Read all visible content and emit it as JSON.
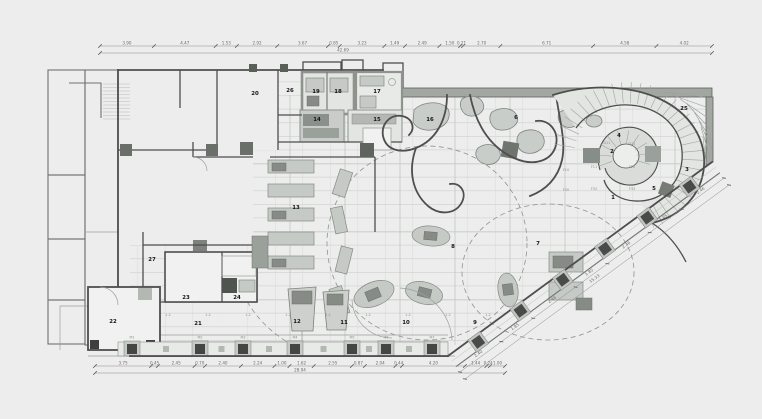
{
  "drawing": {
    "background": "#ecedec",
    "line_dark": "#4e4e4e",
    "line_mid": "#8a8f8a",
    "line_light": "#cdd0cd",
    "furniture_fill": "#c6cac6",
    "poche_fill": "#a2a7a2",
    "room_label_color": "#151515",
    "dim_color": "#6d6d6d"
  },
  "rooms": [
    {
      "n": "1",
      "x": 613,
      "y": 199
    },
    {
      "n": "2",
      "x": 612,
      "y": 153
    },
    {
      "n": "3",
      "x": 687,
      "y": 171
    },
    {
      "n": "4",
      "x": 619,
      "y": 137
    },
    {
      "n": "5",
      "x": 654,
      "y": 190
    },
    {
      "n": "6",
      "x": 516,
      "y": 119
    },
    {
      "n": "7",
      "x": 538,
      "y": 245
    },
    {
      "n": "8",
      "x": 453,
      "y": 248
    },
    {
      "n": "9",
      "x": 475,
      "y": 324
    },
    {
      "n": "10",
      "x": 406,
      "y": 324
    },
    {
      "n": "11",
      "x": 344,
      "y": 324
    },
    {
      "n": "12",
      "x": 297,
      "y": 323
    },
    {
      "n": "13",
      "x": 296,
      "y": 209
    },
    {
      "n": "14",
      "x": 317,
      "y": 121
    },
    {
      "n": "15",
      "x": 377,
      "y": 121
    },
    {
      "n": "16",
      "x": 430,
      "y": 121
    },
    {
      "n": "17",
      "x": 377,
      "y": 93
    },
    {
      "n": "18",
      "x": 338,
      "y": 93
    },
    {
      "n": "19",
      "x": 316,
      "y": 93
    },
    {
      "n": "20",
      "x": 255,
      "y": 95
    },
    {
      "n": "21",
      "x": 198,
      "y": 325
    },
    {
      "n": "22",
      "x": 113,
      "y": 323
    },
    {
      "n": "23",
      "x": 186,
      "y": 299
    },
    {
      "n": "24",
      "x": 237,
      "y": 299
    },
    {
      "n": "25",
      "x": 684,
      "y": 110
    },
    {
      "n": "26",
      "x": 290,
      "y": 92
    },
    {
      "n": "27",
      "x": 152,
      "y": 261
    }
  ],
  "codes": [
    {
      "t": "D11",
      "x": 607,
      "y": 144
    },
    {
      "t": "D12",
      "x": 632,
      "y": 145
    },
    {
      "t": "F11",
      "x": 594,
      "y": 168
    },
    {
      "t": "F12",
      "x": 632,
      "y": 168
    },
    {
      "t": "F32",
      "x": 594,
      "y": 190
    },
    {
      "t": "F33",
      "x": 632,
      "y": 190
    },
    {
      "t": "F10",
      "x": 566,
      "y": 171
    },
    {
      "t": "F30",
      "x": 566,
      "y": 191
    },
    {
      "t": "1.2",
      "x": 168,
      "y": 316
    },
    {
      "t": "1.2",
      "x": 208,
      "y": 316
    },
    {
      "t": "1.2",
      "x": 248,
      "y": 316
    },
    {
      "t": "1.2",
      "x": 288,
      "y": 316
    },
    {
      "t": "1.2",
      "x": 328,
      "y": 316
    },
    {
      "t": "1.2",
      "x": 368,
      "y": 316
    },
    {
      "t": "1.2",
      "x": 408,
      "y": 316
    },
    {
      "t": "1.2",
      "x": 448,
      "y": 316
    },
    {
      "t": "1.2",
      "x": 488,
      "y": 316
    },
    {
      "t": "M1",
      "x": 132,
      "y": 338.5
    },
    {
      "t": "M2",
      "x": 200,
      "y": 338.5
    },
    {
      "t": "M3",
      "x": 243,
      "y": 338.5
    },
    {
      "t": "M4",
      "x": 295,
      "y": 338.5
    },
    {
      "t": "M5",
      "x": 352,
      "y": 338.5
    },
    {
      "t": "M6",
      "x": 386,
      "y": 338.5
    },
    {
      "t": "M7",
      "x": 432,
      "y": 338.5
    }
  ],
  "dimensions": {
    "top": {
      "y": 46,
      "x_start": 100,
      "x_end": 712,
      "values": [
        "3.90",
        "4.47",
        "1.53",
        "2.92",
        "3.67",
        "0.85",
        "3.23",
        "1.49",
        "2.49",
        "1.50",
        "0.21",
        "2.70",
        "6.71",
        "4.58",
        "4.02"
      ]
    },
    "top_total": {
      "y": 53,
      "x_start": 100,
      "x_end": 712,
      "label": "42.69",
      "label_x": 343
    },
    "bottom": {
      "y": 366,
      "x_start": 95,
      "x_end": 505,
      "values": [
        "3.75",
        "0.45",
        "2.45",
        "0.70",
        "2.40",
        "2.24",
        "1.00",
        "1.62",
        "2.55",
        "0.87",
        "2.04",
        "0.44",
        "4.20",
        "1.44",
        "0.24",
        "1.00"
      ]
    },
    "bottom_total": {
      "y": 373,
      "x_start": 95,
      "x_end": 505,
      "label": "28.94",
      "label_x": 300
    },
    "diagonal": {
      "x1": 460,
      "y1": 372,
      "x2": 724,
      "y2": 178,
      "values": [
        "2.40",
        "1.85",
        "2.46",
        "1.85",
        "2.46",
        "1.85",
        "2.46"
      ]
    },
    "diagonal_total": {
      "x1": 465,
      "y1": 379,
      "x2": 729,
      "y2": 185,
      "label": "15.33"
    }
  }
}
